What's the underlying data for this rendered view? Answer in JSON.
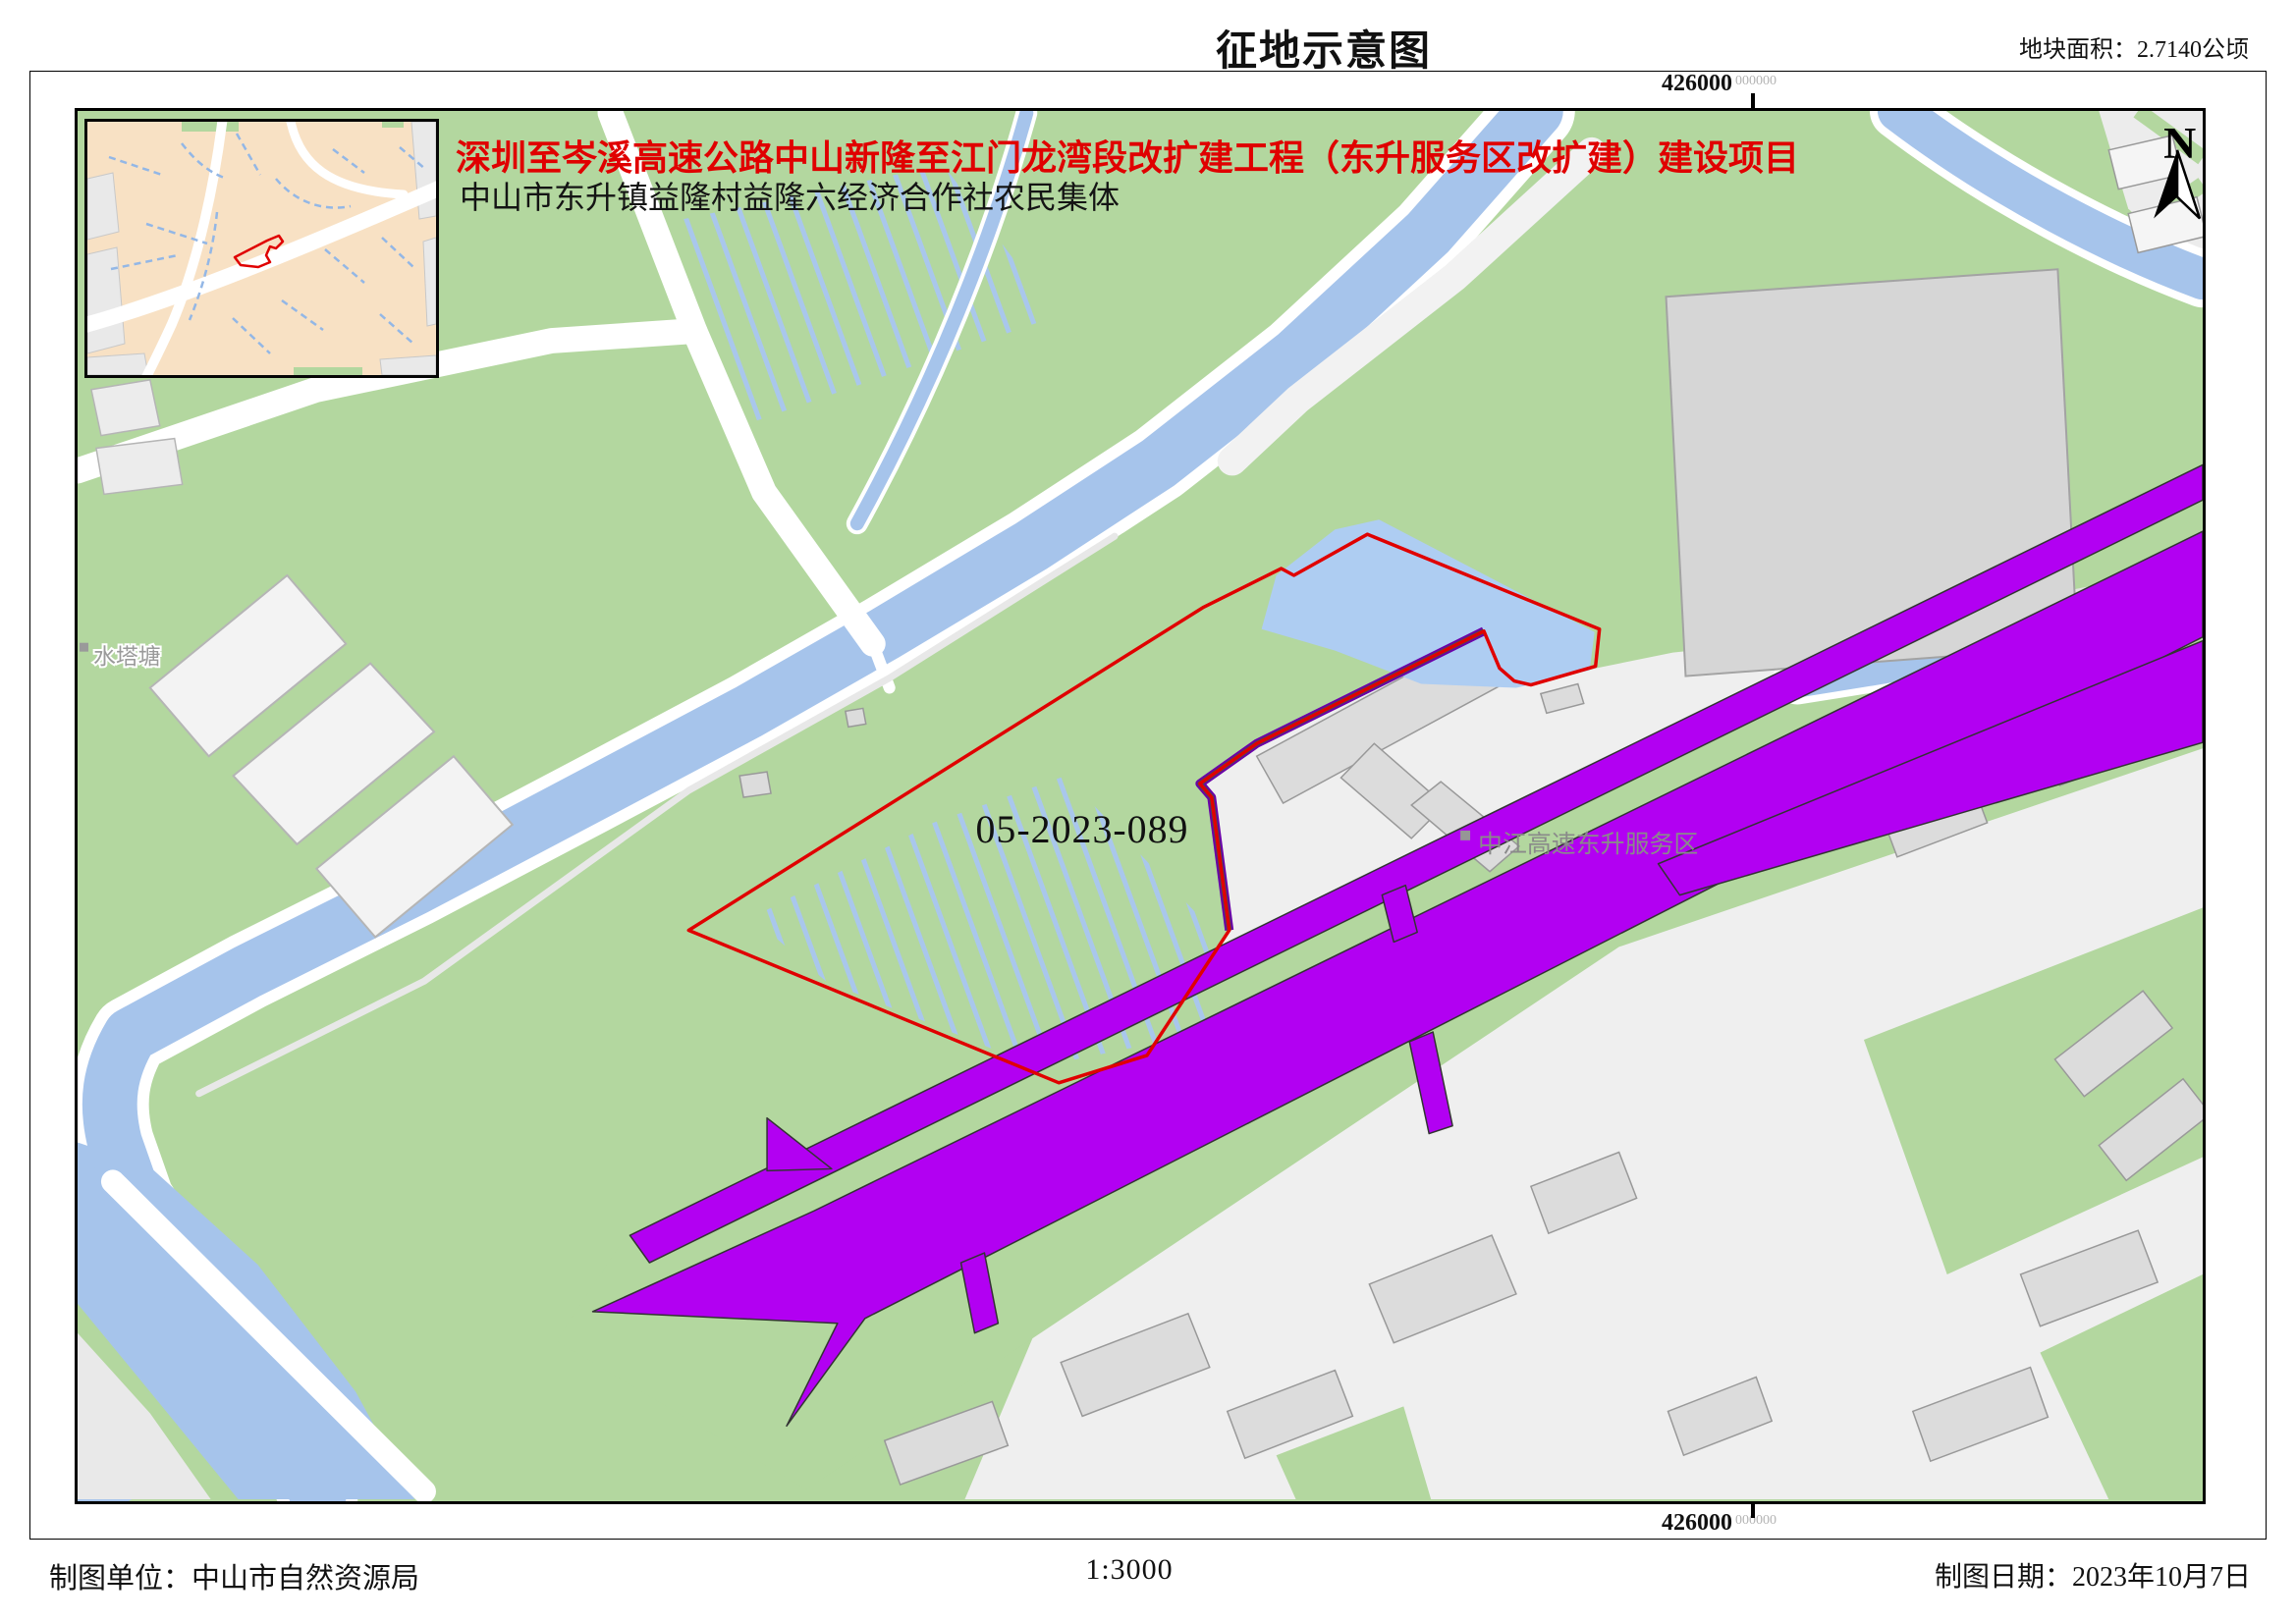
{
  "page_title": "征地示意图",
  "area_label": "地块面积：2.7140公顷",
  "header": {
    "project_title": "深圳至岑溪高速公路中山新隆至江门龙湾段改扩建工程（东升服务区改扩建）建设项目",
    "community": "中山市东升镇益隆村益隆六经济合作社农民集体"
  },
  "coordinates": {
    "top_main": "426000",
    "top_sub": "000000",
    "bottom_main": "426000",
    "bottom_sub": "000000"
  },
  "map": {
    "parcel_id": "05-2023-089",
    "service_area_label": "中江高速东升服务区",
    "pond_label": "水塔塘",
    "north_label": "N"
  },
  "footer": {
    "agency": "制图单位：中山市自然资源局",
    "scale": "1:3000",
    "date": "制图日期：2023年10月7日"
  },
  "colors": {
    "parcel_outline": "#e00000",
    "highway": "#b200f2",
    "water": "#a6c4eb",
    "pond": "#aecdf2",
    "greenland": "#b3d79f",
    "built_area": "#efefef",
    "inset_background": "#f8e1c4"
  }
}
